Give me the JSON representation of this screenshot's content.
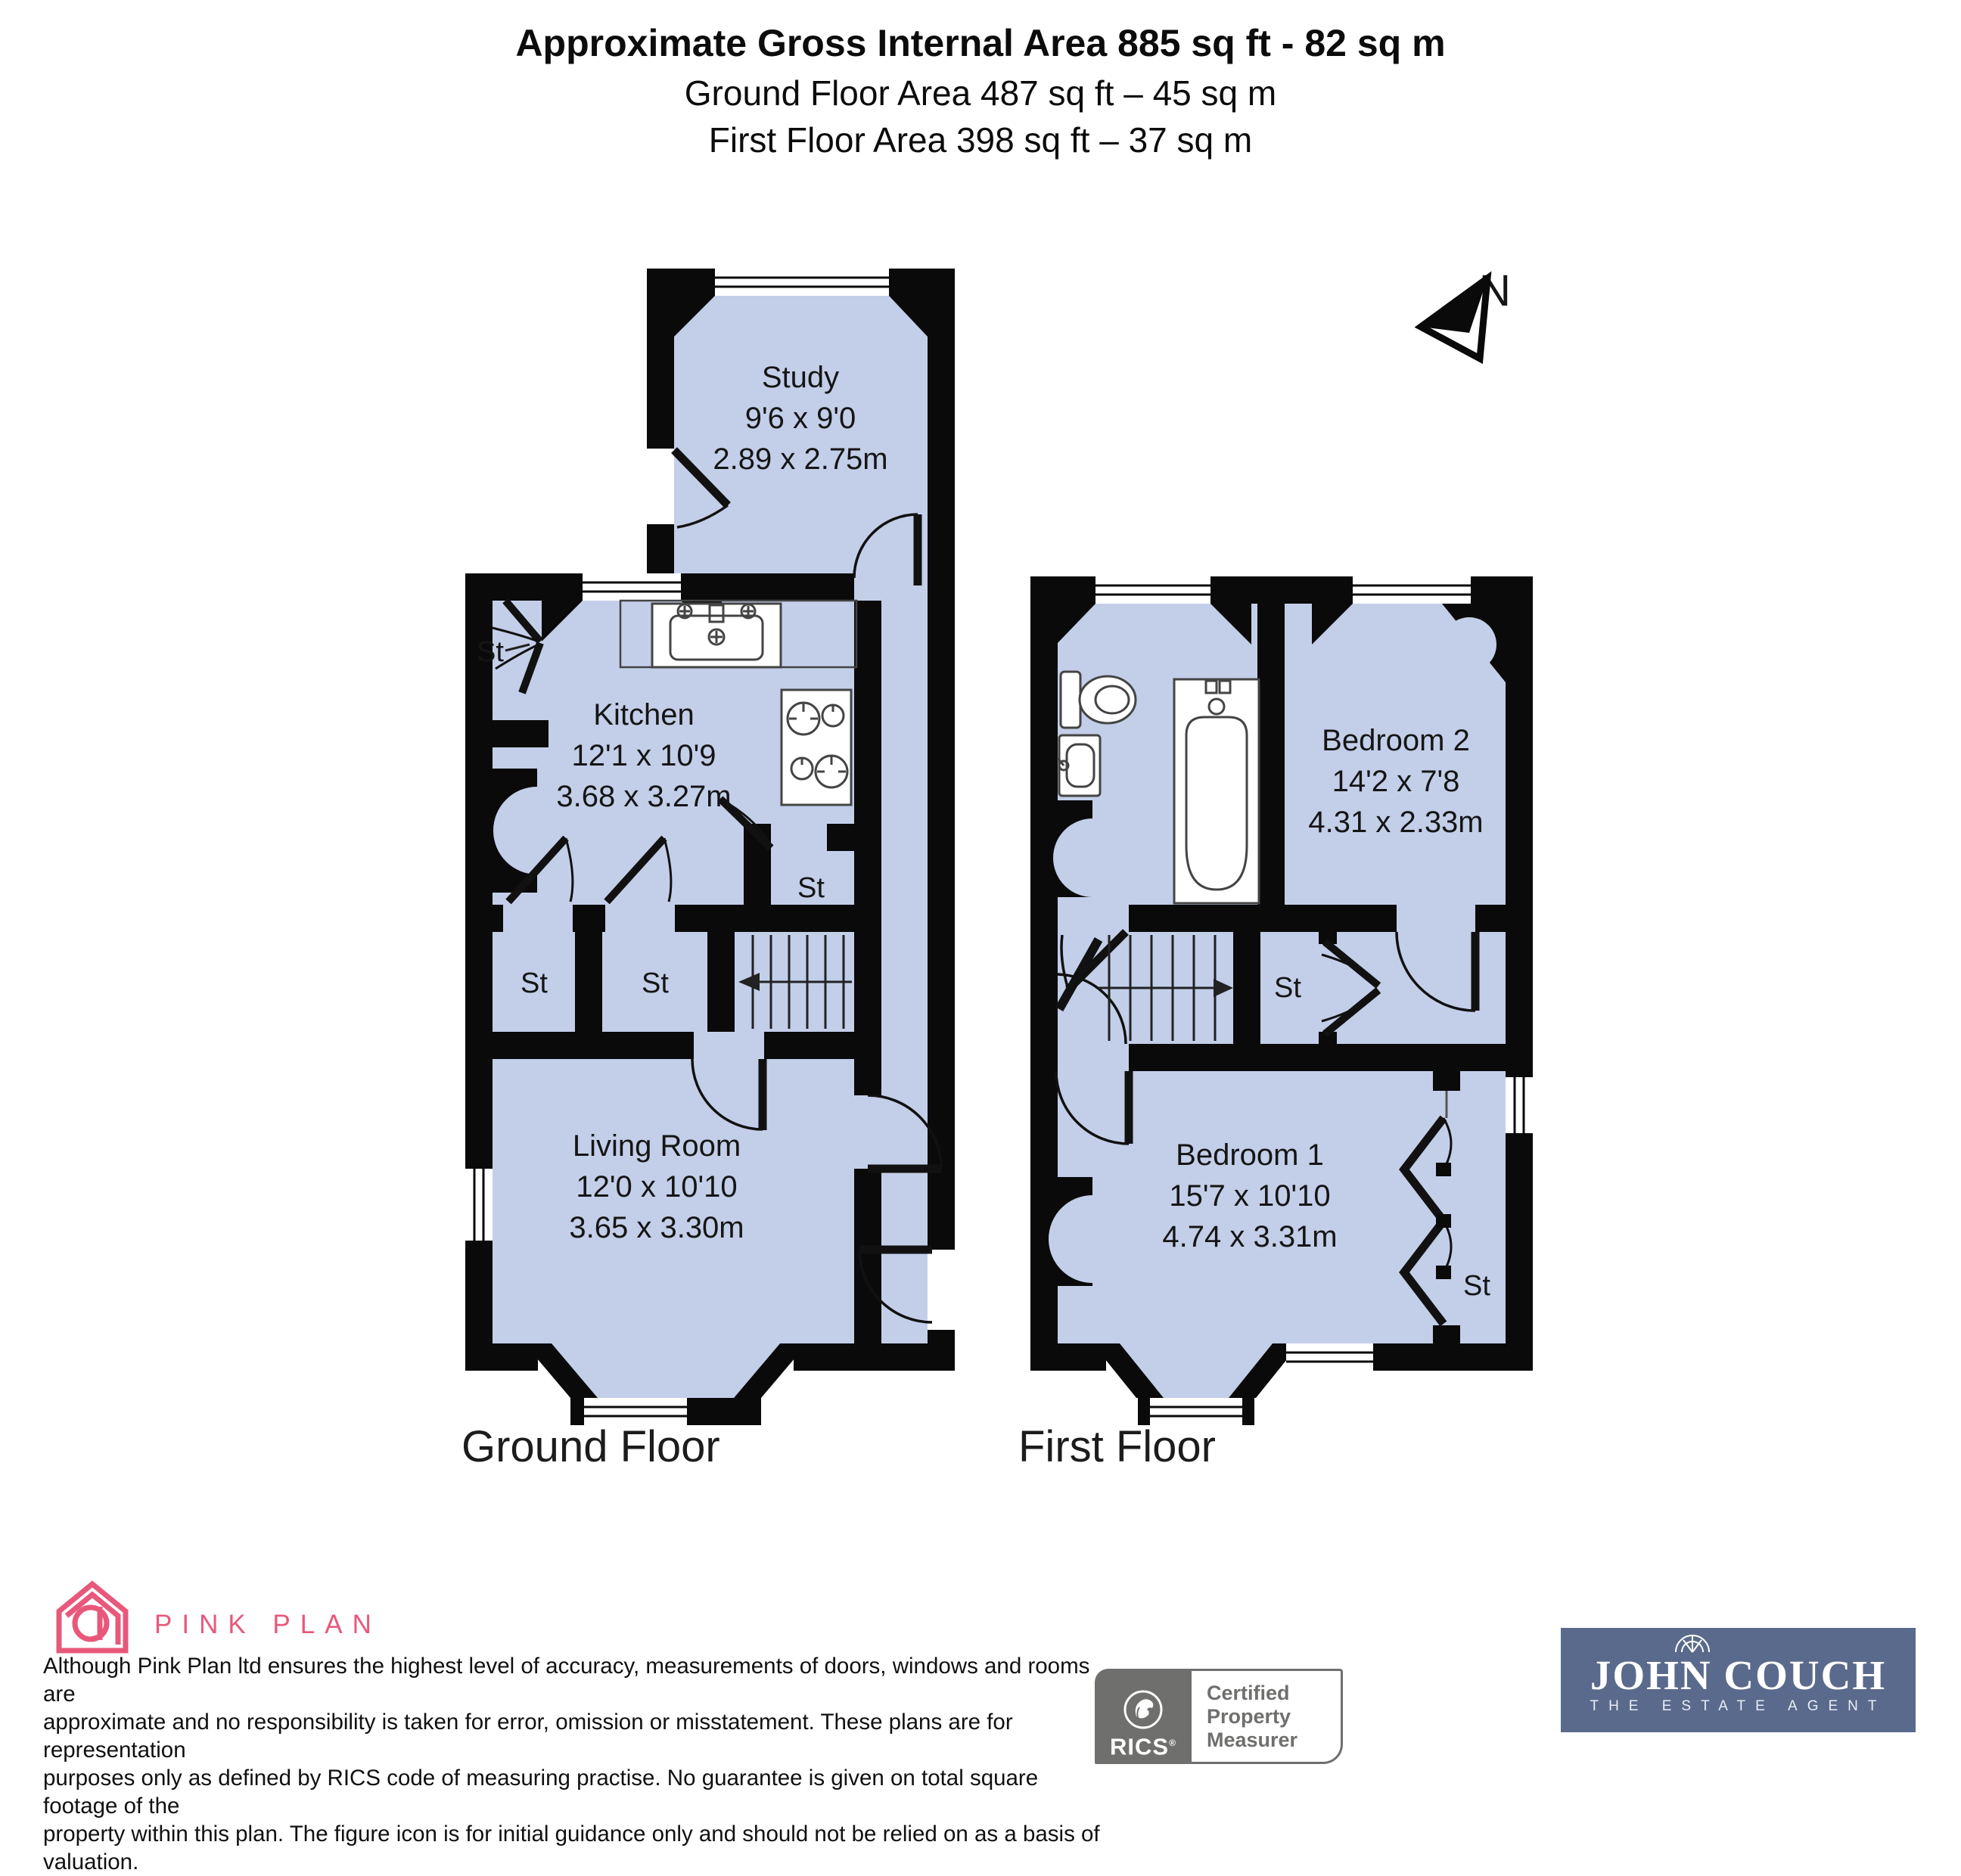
{
  "header": {
    "title": "Approximate Gross Internal Area 885 sq ft - 82 sq m",
    "ground_area": "Ground Floor Area 487 sq ft – 45 sq m",
    "first_area": "First Floor Area 398 sq ft – 37 sq m"
  },
  "compass": {
    "north_label": "N"
  },
  "ground_floor": {
    "name": "Ground Floor",
    "rooms": [
      {
        "name": "Study",
        "imperial": "9'6 x 9'0",
        "metric": "2.89 x 2.75m"
      },
      {
        "name": "Kitchen",
        "imperial": "12'1 x 10'9",
        "metric": "3.68 x 3.27m"
      },
      {
        "name": "Living Room",
        "imperial": "12'0 x 10'10",
        "metric": "3.65 x 3.30m"
      }
    ],
    "storage_labels": [
      "St",
      "St",
      "St",
      "St"
    ]
  },
  "first_floor": {
    "name": "First Floor",
    "rooms": [
      {
        "name": "Bedroom 2",
        "imperial": "14'2 x 7'8",
        "metric": "4.31 x 2.33m"
      },
      {
        "name": "Bedroom 1",
        "imperial": "15'7 x 10'10",
        "metric": "4.74 x 3.31m"
      }
    ],
    "storage_labels": [
      "St",
      "St"
    ]
  },
  "colors": {
    "room_fill": "#c3cfe9",
    "wall": "#0a0a0a",
    "brand_pink": "#e8587b",
    "rics_gray": "#6f6f6e",
    "agent_blue": "#5a6a8c"
  },
  "footer": {
    "brand": "PINK PLAN",
    "disclaimer_lines": [
      "Although Pink Plan ltd ensures the highest level of accuracy, measurements of doors, windows and rooms are",
      "approximate and no responsibility is taken for error, omission or misstatement. These plans are for representation",
      "purposes only as defined by RICS code of measuring practise. No guarantee is given on total square footage of the",
      "property within this plan. The figure icon is for initial guidance only and should not be relied on as a basis of valuation."
    ],
    "rics": {
      "name": "RICS",
      "reg": "®",
      "lines": [
        "Certified",
        "Property",
        "Measurer"
      ]
    },
    "agent": {
      "name": "JOHN COUCH",
      "tagline": "THE ESTATE AGENT"
    }
  }
}
